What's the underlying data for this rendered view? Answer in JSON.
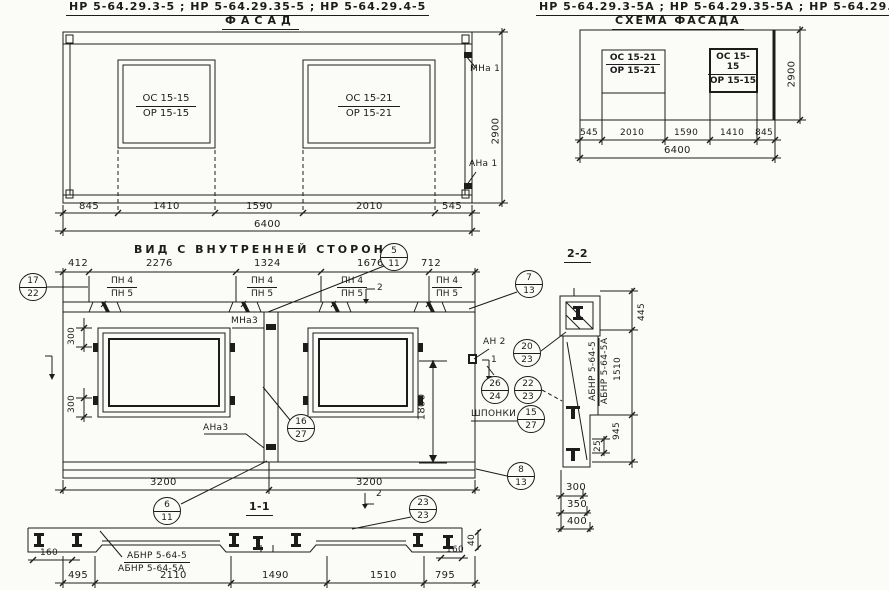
{
  "titles": {
    "left": "НР 5-64.29.3-5 ; НР 5-64.29.35-5 ; НР 5-64.29.4-5",
    "right": "НР 5-64.29.3-5А ; НР 5-64.29.35-5А ; НР 5-64.29.4-5А"
  },
  "facade": {
    "title": "ФАСАД",
    "window_left": {
      "top": "ОС 15-15",
      "bottom": "ОР 15-15"
    },
    "window_right": {
      "top": "ОС 15-21",
      "bottom": "ОР 15-21"
    },
    "node_top": "МНа 1",
    "node_bottom": "АНа 1",
    "dims": {
      "segments": [
        "845",
        "1410",
        "1590",
        "2010",
        "545"
      ],
      "total": "6400",
      "height": "2900"
    }
  },
  "schema": {
    "title": "СХЕМА ФАСАДА",
    "window_left": {
      "top": "ОС 15-21",
      "bottom": "ОР 15-21"
    },
    "window_right": {
      "top": "ОС 15-15",
      "bottom": "ОР 15-15"
    },
    "dims": {
      "segments": [
        "545",
        "2010",
        "1590",
        "1410",
        "845"
      ],
      "total": "6400",
      "height": "2900"
    }
  },
  "inner": {
    "title": "ВИД С ВНУТРЕННЕЙ СТОРОНЫ",
    "dims_top": [
      "412",
      "2276",
      "1324",
      "1676",
      "712"
    ],
    "pn": {
      "top": "ПН 4",
      "bottom": "ПН 5"
    },
    "node_top": "МНа3",
    "node_bottom": "АНа3",
    "node_an2": "АН 2",
    "keys_label": "ШПОНКИ",
    "dim_300": "300",
    "dim_1800": "1800",
    "dim_3200_left": "3200",
    "dim_3200_right": "3200",
    "section_1_title": "1-1",
    "flag_1": "1",
    "flag_2": "2",
    "circles": [
      {
        "top": "17",
        "bottom": "22"
      },
      {
        "top": "5",
        "bottom": "11"
      },
      {
        "top": "7",
        "bottom": "13"
      },
      {
        "top": "16",
        "bottom": "27"
      },
      {
        "top": "20",
        "bottom": "23"
      },
      {
        "top": "26",
        "bottom": "24"
      },
      {
        "top": "22",
        "bottom": "23"
      },
      {
        "top": "15",
        "bottom": "27"
      },
      {
        "top": "6",
        "bottom": "11"
      },
      {
        "top": "23",
        "bottom": "23"
      },
      {
        "top": "8",
        "bottom": "13"
      }
    ]
  },
  "section11": {
    "label_line1": "АБНР 5-64-5",
    "label_line2": "АБНР 5-64-5А",
    "dims": {
      "segments": [
        "495",
        "2110",
        "1490",
        "1510",
        "795"
      ],
      "left": "160",
      "right": "160",
      "edge": "40"
    }
  },
  "section22": {
    "title": "2-2",
    "label_line1": "АБНР 5-64-5",
    "label_line2": "АБНР 5-64-5А",
    "dims": {
      "vertical": [
        "445",
        "1510",
        "945"
      ],
      "small": "25",
      "bottom": [
        "300",
        "350",
        "400"
      ]
    }
  }
}
